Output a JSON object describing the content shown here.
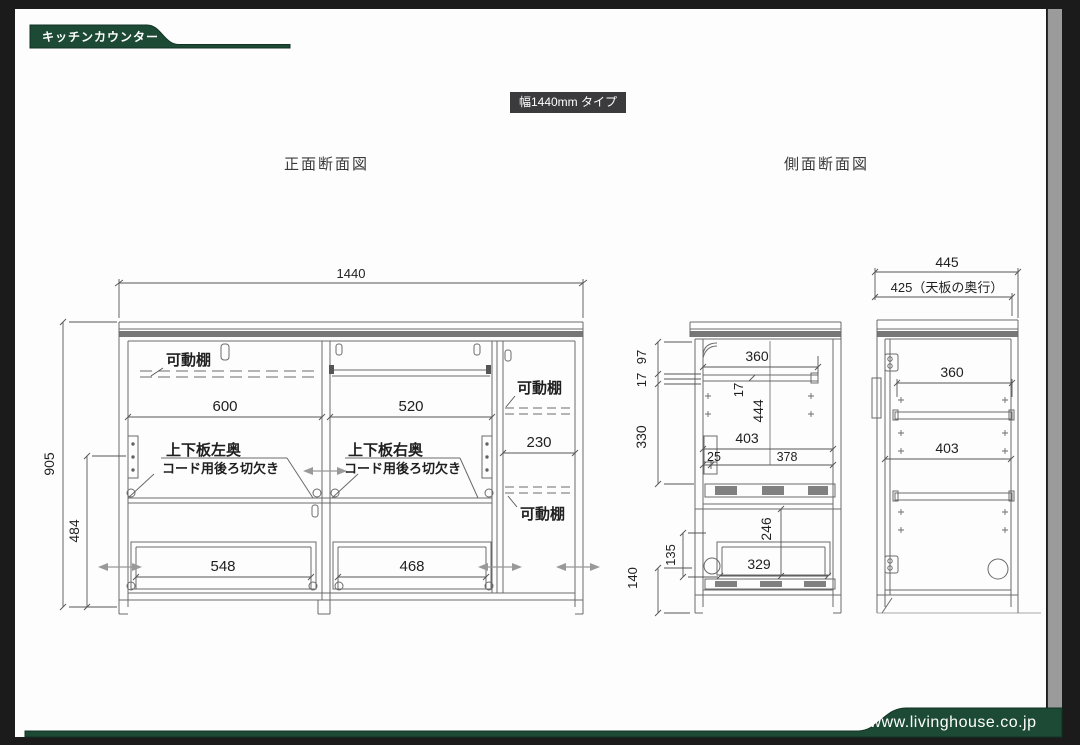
{
  "page": {
    "tab_title": "キッチンカウンター",
    "type_badge": "幅1440mm タイプ",
    "footer_url": "www.livinghouse.co.jp",
    "accent_green": "#1c4a35"
  },
  "front_view": {
    "title": "正面断面図",
    "dims": {
      "total_width": "1440",
      "total_height": "905",
      "lower_height": "484",
      "left_bay": "600",
      "center_bay": "520",
      "right_bay": "230",
      "left_drawer": "548",
      "right_drawer": "468"
    },
    "labels": {
      "movable_shelf": "可動棚",
      "notch_left_title": "上下板左奥",
      "notch_right_title": "上下板右奥",
      "cord_notch": "コード用後ろ切欠き"
    }
  },
  "side_view": {
    "title": "側面断面図",
    "dims": {
      "top": "97",
      "shelf_gap": "17",
      "upper": "330",
      "inner_width": "360",
      "shelf_thickness": "17",
      "inner_height": "444",
      "depth": "403",
      "back": "25",
      "front": "378",
      "drawer_height": "246",
      "drawer_depth": "329",
      "rail": "135",
      "base": "140"
    }
  },
  "right_view": {
    "dims": {
      "total_depth": "445",
      "top_depth": "425（天板の奥行）",
      "shelf_width": "360",
      "inner_depth": "403"
    }
  }
}
